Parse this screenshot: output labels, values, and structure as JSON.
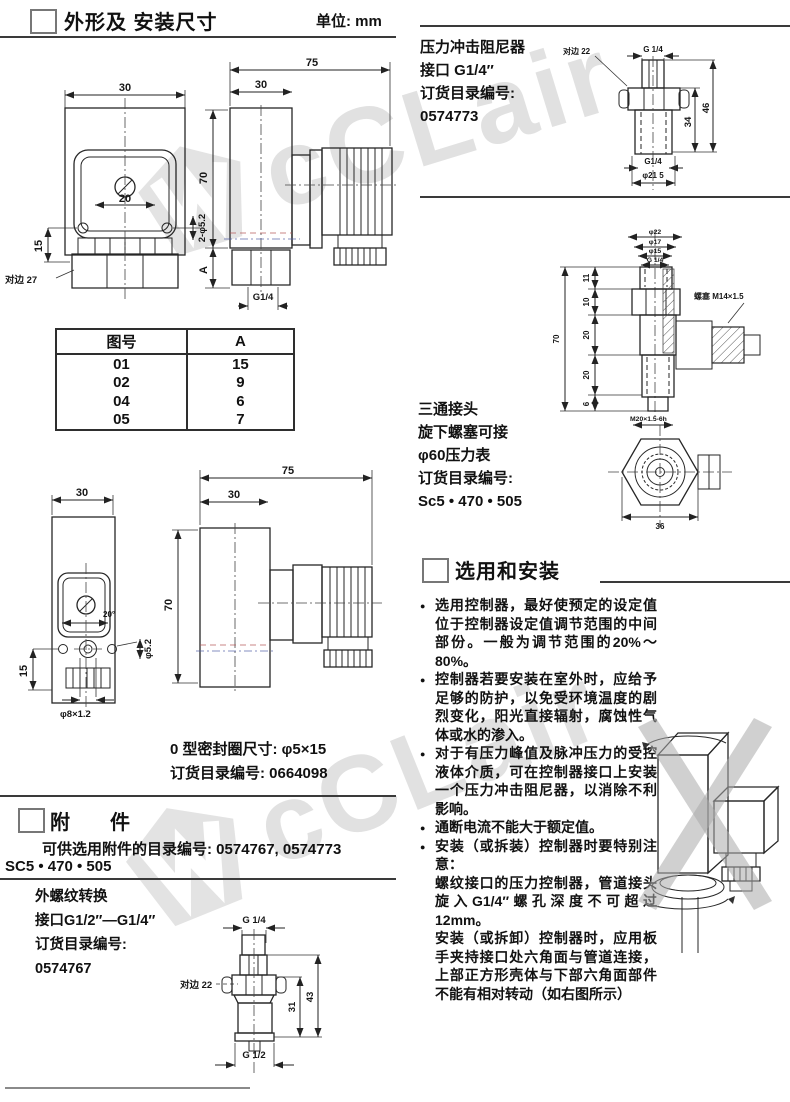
{
  "outline": {
    "title": "外形及 安装尺寸",
    "unit": "单位: mm",
    "oring_note1": "0 型密封圈尺寸: φ5×15",
    "oring_note2": "订货目录编号: 0664098"
  },
  "table": {
    "headers": [
      "图号",
      "A"
    ],
    "rows": [
      [
        "01",
        "15"
      ],
      [
        "02",
        "9"
      ],
      [
        "04",
        "6"
      ],
      [
        "05",
        "7"
      ]
    ]
  },
  "dwg": {
    "f1": {
      "w": "30",
      "inner": "20",
      "holes": "2-φ5.2",
      "h15": "15",
      "hex": "对边 27"
    },
    "s1": {
      "w75": "75",
      "w30": "30",
      "h70": "70",
      "a": "A",
      "g": "G1/4"
    },
    "f2": {
      "w": "30",
      "ang": "20°",
      "h15": "15",
      "hole": "φ5.2",
      "boss": "φ8×1.2"
    },
    "s2": {
      "w75": "75",
      "w30": "30",
      "h70": "70"
    },
    "damper": {
      "hex": "对边 22",
      "gt": "G 1/4",
      "d34": "34",
      "d46": "46",
      "gb": "G1/4",
      "dia": "φ21 5"
    },
    "tee": {
      "d22": "φ22",
      "d17": "φ17",
      "d15": "φ15",
      "g": "G 1/4",
      "v11": "11",
      "v10": "10",
      "v20a": "20",
      "v20b": "20",
      "v6": "6",
      "v70": "70",
      "plug": "螺塞 M14×1.5",
      "m20": "M20×1.5-6h",
      "w36": "36"
    },
    "adp": {
      "gt": "G 1/4",
      "hex": "对边 22",
      "d31": "31",
      "d43": "43",
      "gb": "G 1/2"
    }
  },
  "damper": {
    "line1": "压力冲击阻尼器",
    "line2": "接口 G1/4″",
    "line3": "订货目录编号:",
    "line4": "0574773"
  },
  "tee": {
    "line1": "三通接头",
    "line2": "旋下螺塞可接",
    "line3": "φ60压力表",
    "line4": "订货目录编号:",
    "line5": "Sc5 • 470 • 505"
  },
  "install": {
    "title": "选用和安装",
    "bullets": [
      "选用控制器，最好使预定的设定值位于控制器设定值调节范围的中间部份。一般为调节范围的20%～80%。",
      "控制器若要安装在室外时，应给予足够的防护，以免受环境温度的剧烈变化，阳光直接辐射，腐蚀性气体或水的渗入。",
      "对于有压力峰值及脉冲压力的受控液体介质，可在控制器接口上安装一个压力冲击阻尼器，以消除不利影响。",
      "通断电流不能大于额定值。",
      "安装（或拆装）控制器时要特别注意："
    ],
    "note1": "螺纹接口的压力控制器，管道接头旋入G1/4″螺孔深度不可超过12mm。",
    "note2": "安装（或拆卸）控制器时，应用板手夹持接口处六角面与管道连接，上部正方形壳体与下部六角面部件不能有相对转动（如右图所示）"
  },
  "accessories": {
    "title": "附　件",
    "line1": "可供选用附件的目录编号: 0574767, 0574773",
    "line2": "SC5 • 470 • 505",
    "adapter_line1": "外螺纹转换",
    "adapter_line2": "接口G1/2″—G1/4″",
    "adapter_line3": "订货目录编号:",
    "adapter_line4": "0574767"
  },
  "watermark": {
    "text": "cCLair",
    "color": "#b9b9b9"
  }
}
